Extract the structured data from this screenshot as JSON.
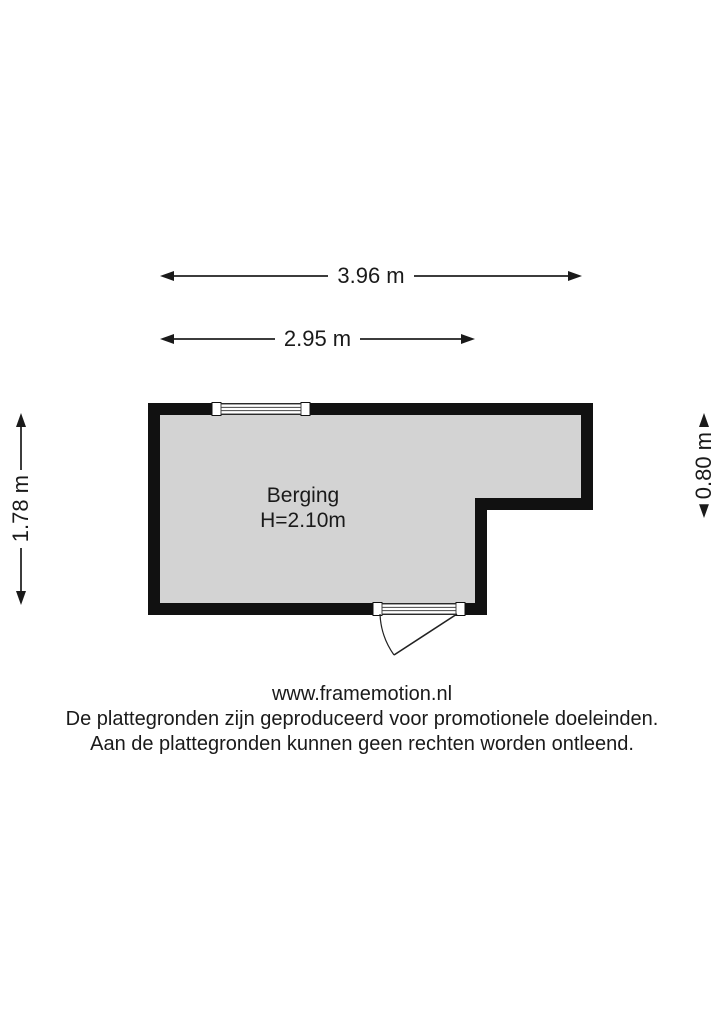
{
  "floorplan": {
    "room": {
      "name": "Berging",
      "ceiling_height": "H=2.10m"
    },
    "dimensions": {
      "width_total": "3.96 m",
      "width_partial": "2.95 m",
      "depth_left": "1.78 m",
      "depth_right": "0.80 m"
    },
    "colors": {
      "wall": "#111111",
      "floor": "#d3d3d3",
      "dimension_line": "#3c3c3c"
    }
  },
  "footer": {
    "website": "www.framemotion.nl",
    "disclaimer_1": "De plattegronden zijn geproduceerd voor promotionele doeleinden.",
    "disclaimer_2": "Aan de plattegronden kunnen geen rechten worden ontleend."
  }
}
